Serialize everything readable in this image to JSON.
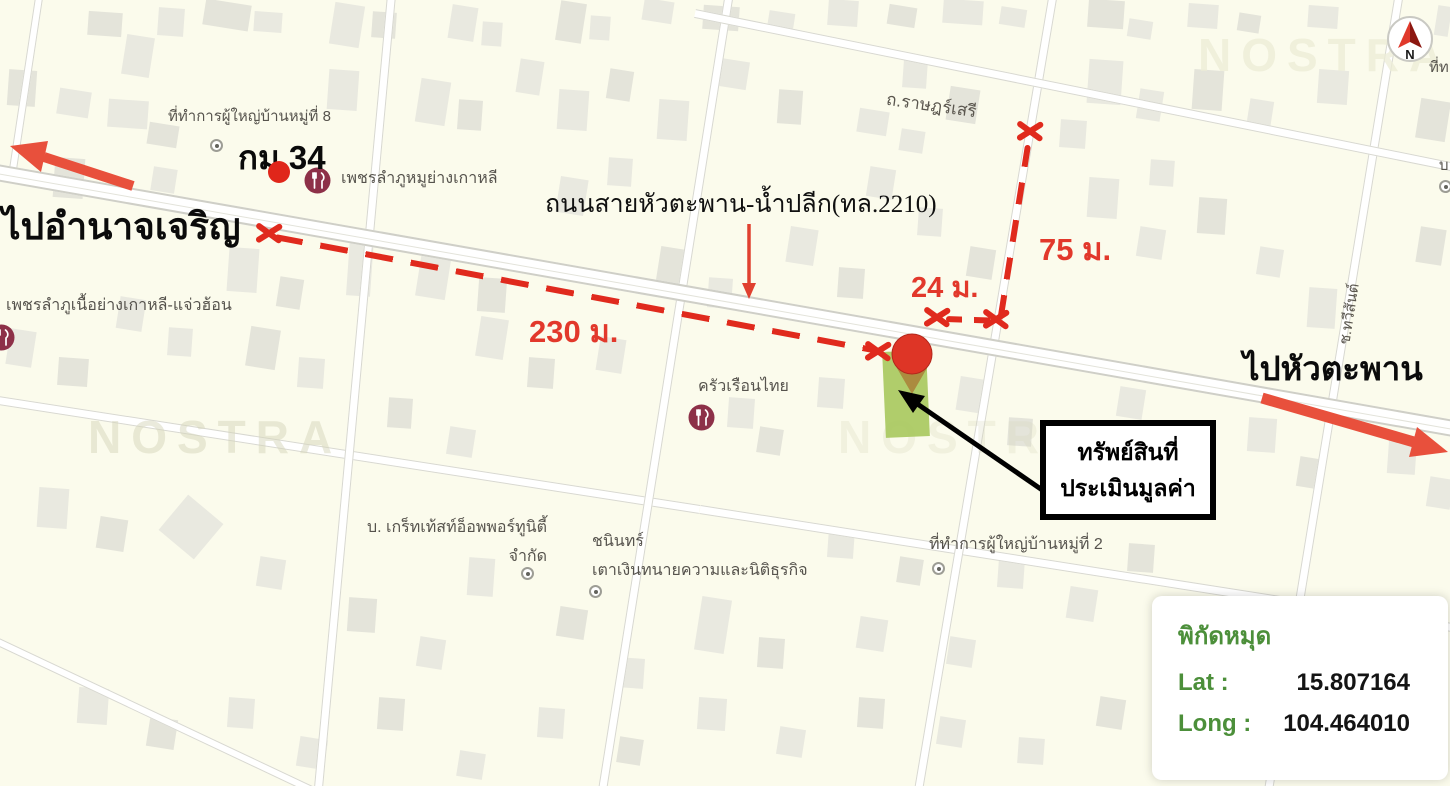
{
  "map": {
    "labels": {
      "dest_left": "ไปอำนาจเจริญ",
      "dest_right": "ไปหัวตะพาน",
      "km_marker": "กม.34",
      "main_road": "ถนนสายหัวตะพาน-น้ำปลีก(ทล.2210)",
      "road_ratsaseri": "ถ.ราษฎร์เสรี",
      "road_soi": "ช.ทวีสันต์",
      "poi_village8": "ที่ทำการผู้ใหญ่บ้านหมู่ที่ 8",
      "poi_restaurant1": "เพชรลำภูหมูย่างเกาหลี",
      "poi_restaurant2": "เพชรลำภูเนื้อย่างเกาหลี-แจ่วฮ้อน",
      "poi_restaurant3": "ครัวเรือนไทย",
      "poi_company_line1": "บ. เกร็ทเท้สท์อ็อพพอร์ทูนิตี้",
      "poi_company_line2": "จำกัด",
      "poi_lawyer_line1": "ชนินทร์",
      "poi_lawyer_line2": "เตาเงินทนายความและนิติธุรกิจ",
      "poi_village2": "ที่ทำการผู้ใหญ่บ้านหมู่ที่ 2",
      "edge_partial_top": "ที่ท",
      "edge_partial_right": "บ",
      "watermark": "NOSTRA",
      "compass_n": "N"
    },
    "measurements": {
      "d230": "230 ม.",
      "d24": "24 ม.",
      "d75": "75 ม."
    },
    "callout": {
      "line1": "ทรัพย์สินที่",
      "line2": "ประเมินมูลค่า"
    },
    "coords": {
      "title": "พิกัดหมุด",
      "lat_label": "Lat :",
      "lat_value": "15.807164",
      "long_label": "Long :",
      "long_value": "104.464010"
    },
    "colors": {
      "annotation_red": "#e02a1d",
      "arrow_red": "#e8503c",
      "parcel_green": "#a9c95f",
      "pin_red": "#de3526",
      "coords_green": "#4c8f3a",
      "map_bg": "#fbfbec"
    }
  }
}
